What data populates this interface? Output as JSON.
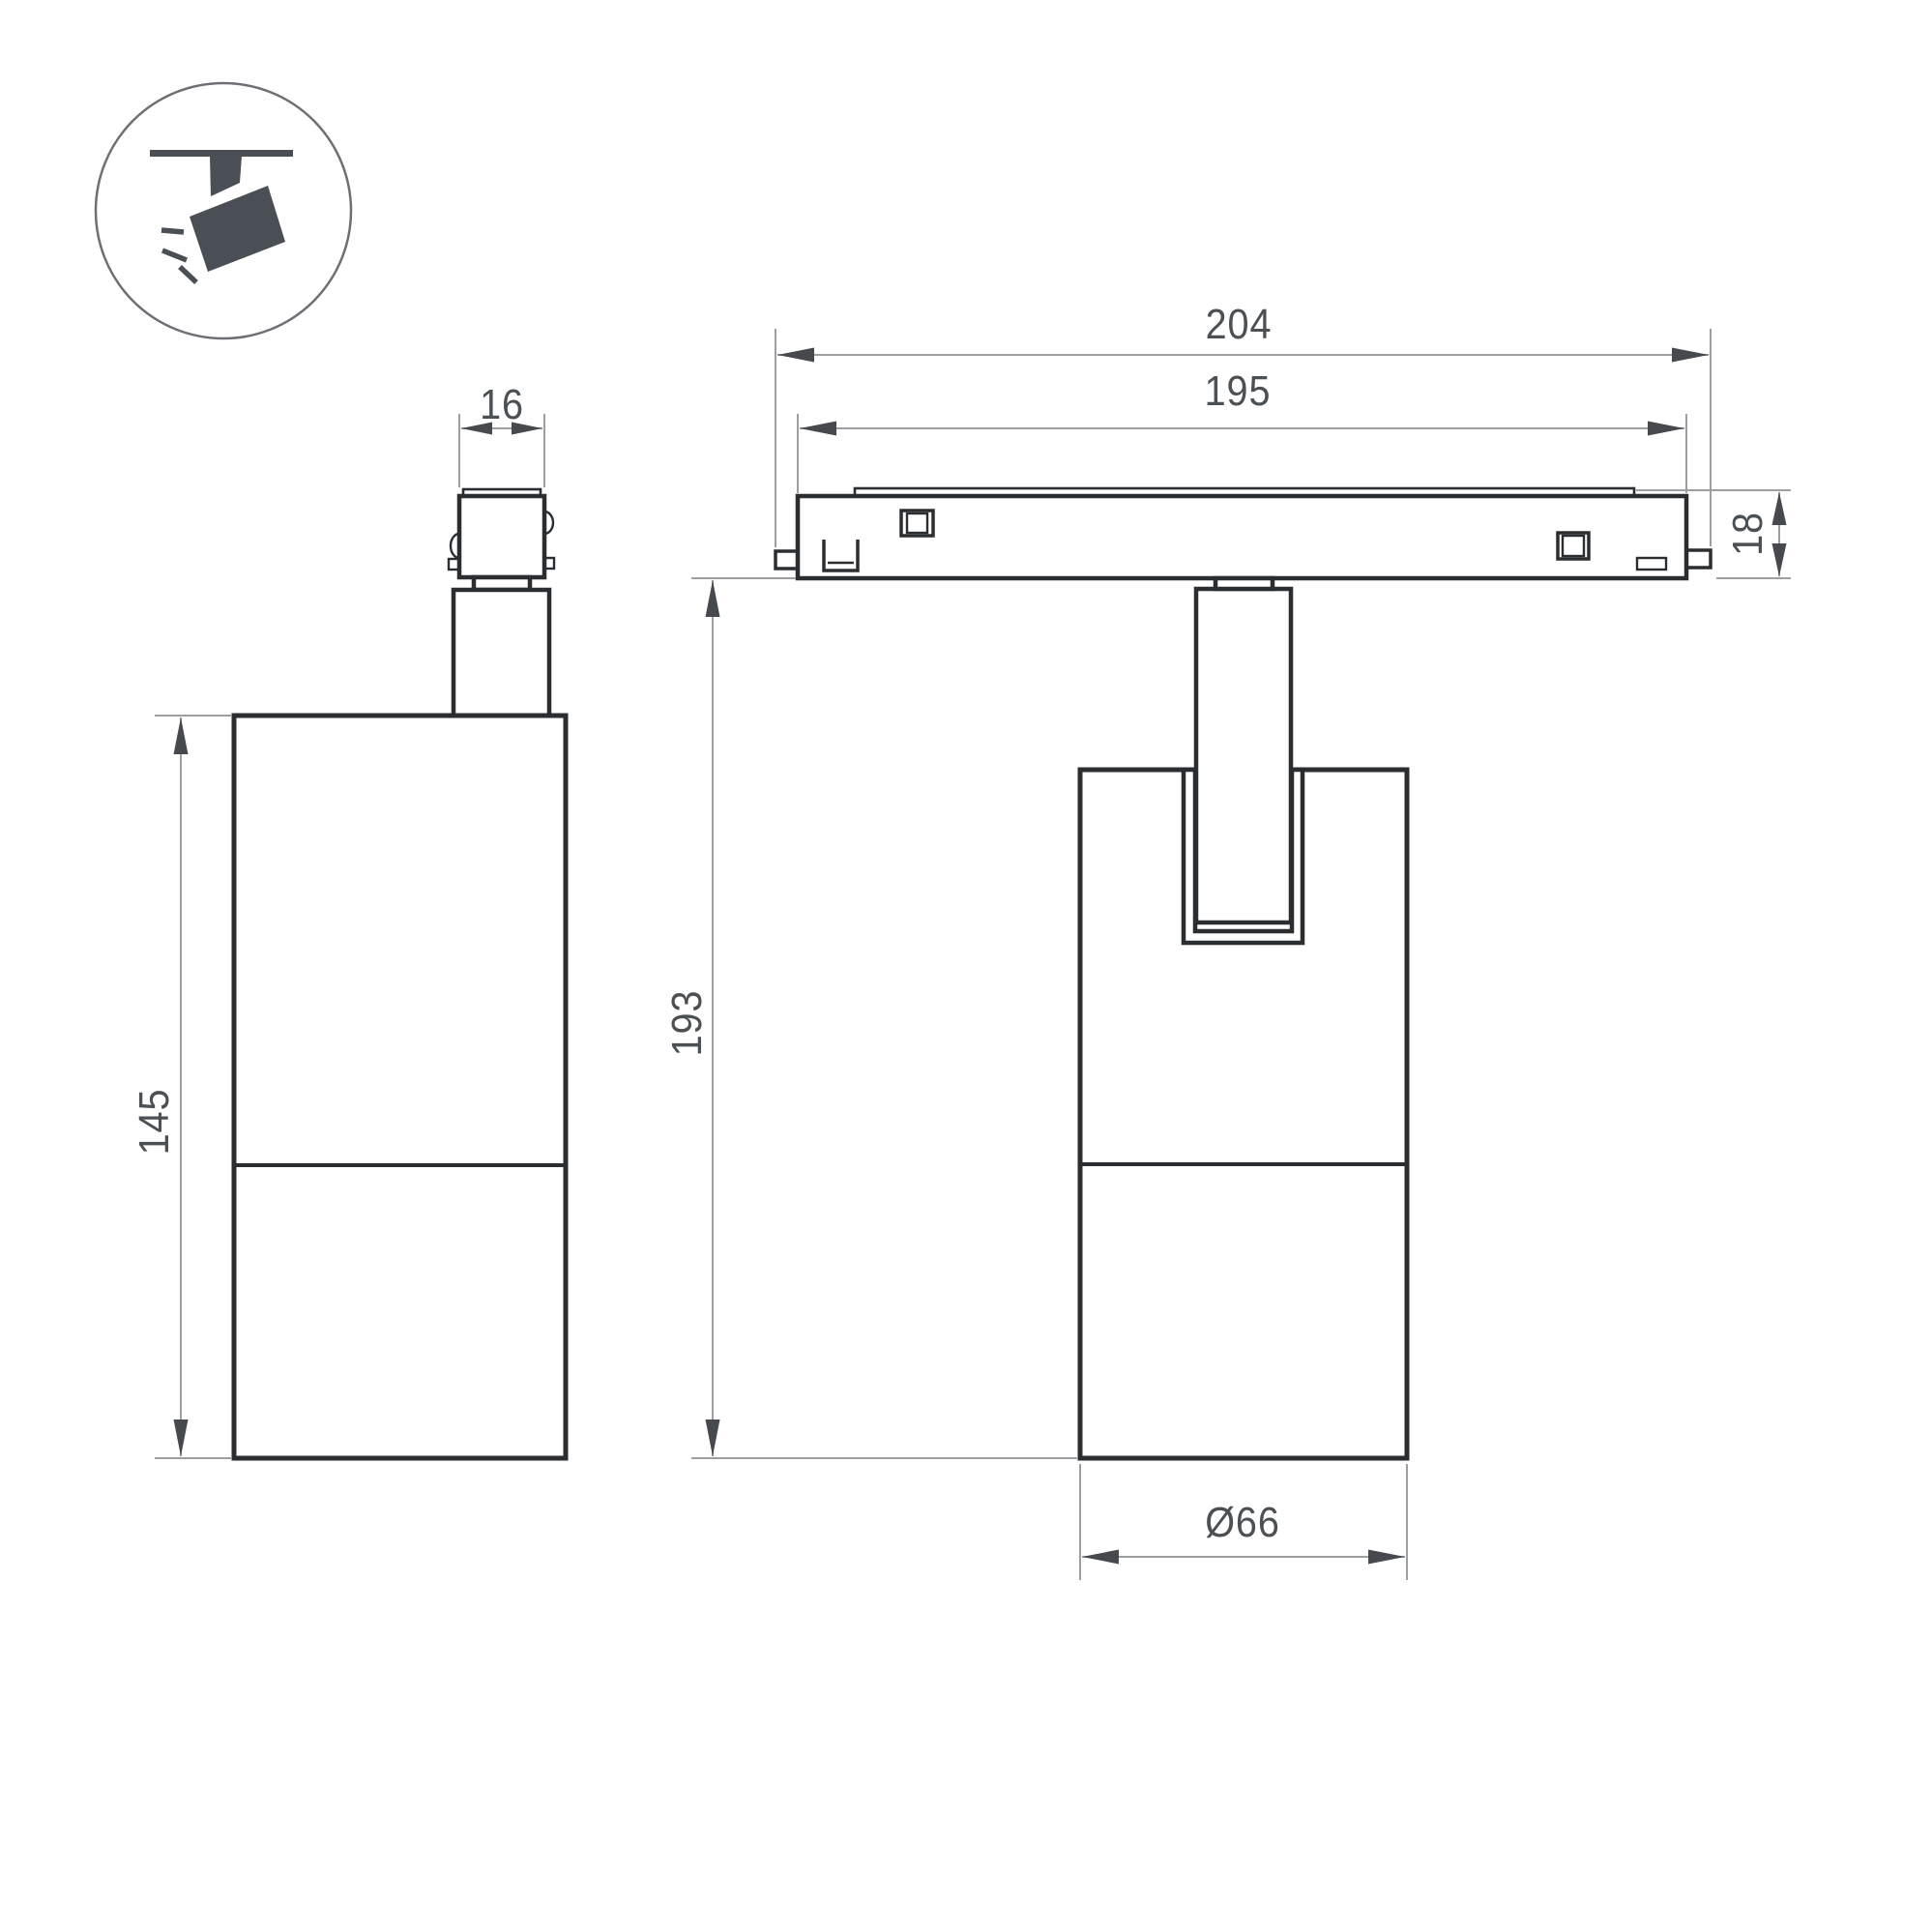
{
  "drawing": {
    "type": "technical-dimension-drawing",
    "background_color": "#ffffff",
    "outline_color": "#2b2e31",
    "dimension_line_color": "#9da0a3",
    "dimension_text_color": "#4b5054",
    "icon_color": "#4a4f55",
    "icon": {
      "name": "ceiling-track-spotlight-icon"
    },
    "labels": {
      "connector_width": "16",
      "side_body_height": "145",
      "track_overall_width": "204",
      "track_inner_width": "195",
      "track_height": "18",
      "overall_height": "193",
      "body_diameter": "Ø66"
    }
  }
}
